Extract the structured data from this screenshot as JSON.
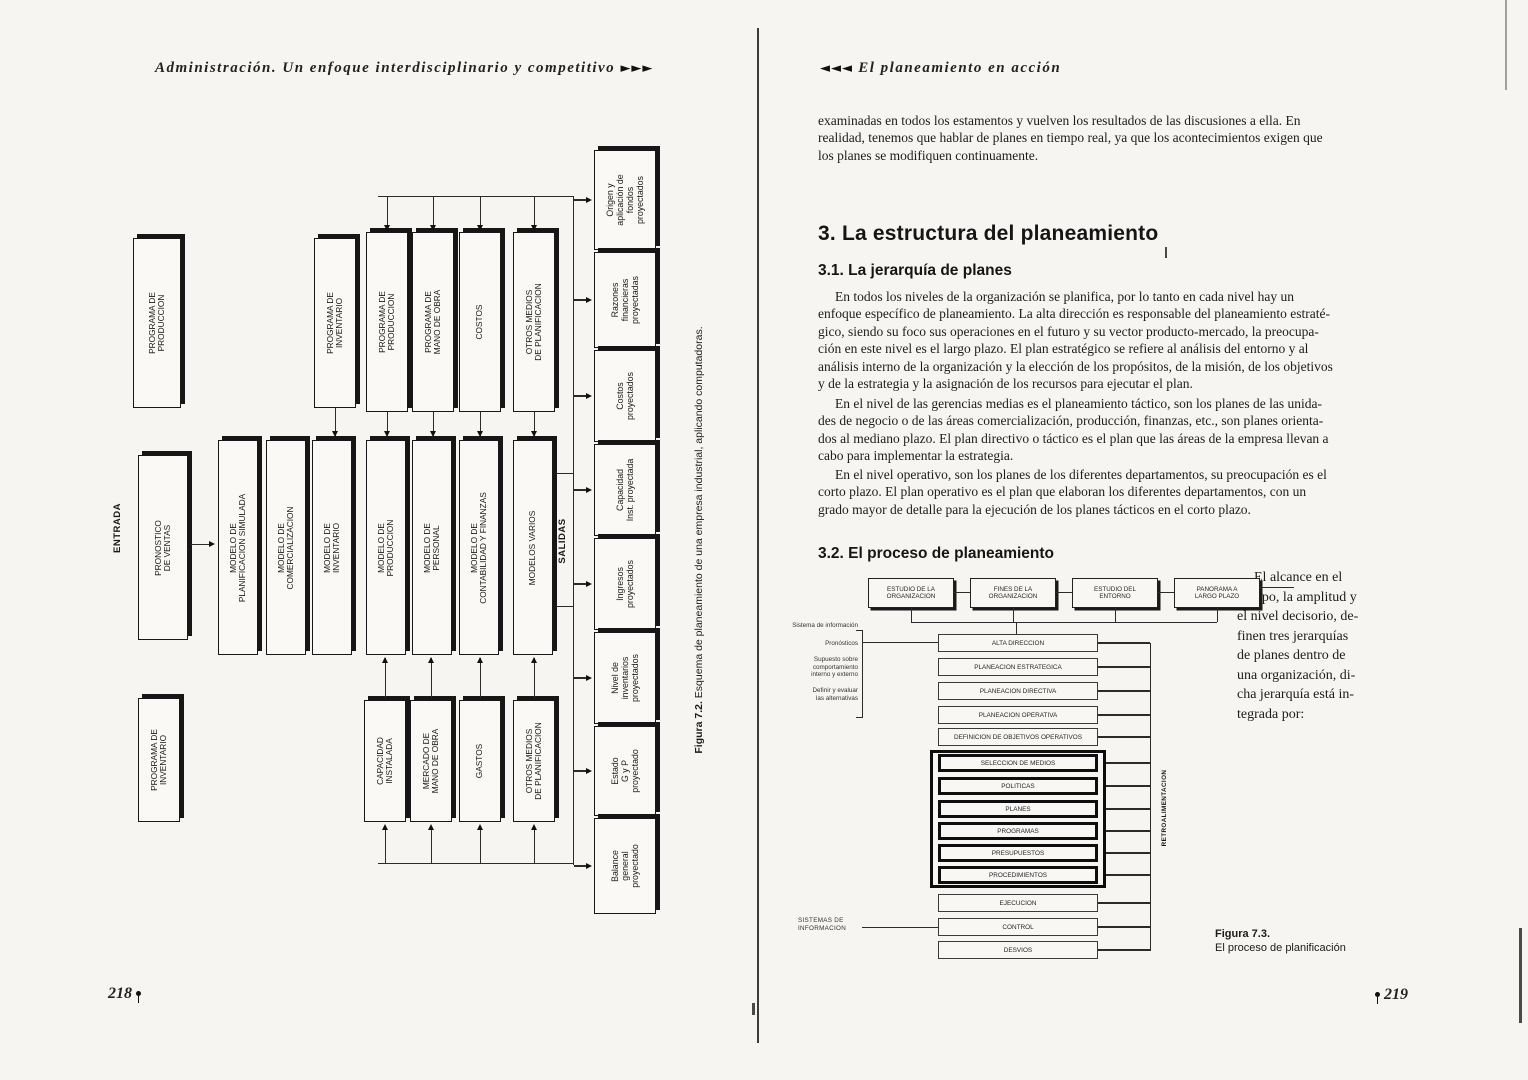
{
  "left_page": {
    "running_header": "Administración. Un enfoque interdisciplinario y competitivo",
    "running_header_arrows": "►►►",
    "page_number": "218",
    "figure": {
      "caption_label": "Figura 7.2.",
      "caption_text": "Esquema de planeamiento de una empresa industrial, aplicando computadoras.",
      "entrada_label": "ENTRADA",
      "salidas_label": "SALIDAS",
      "input_box": "PRONOSTICO\nDE VENTAS",
      "standalone_top": "PROGRAMA DE\nPRODUCCION",
      "standalone_bottom": "PROGRAMA DE\nINVENTARIO",
      "programs_top": [
        "PROGRAMA DE\nINVENTARIO",
        "PROGRAMA DE\nPRODUCCION",
        "PROGRAMA DE\nMANO DE OBRA",
        "COSTOS",
        "OTROS MEDIOS\nDE PLANIFICACION"
      ],
      "models": [
        "MODELO DE\nPLANIFICACION SIMULADA",
        "MODELO DE\nCOMERCIALIZACION",
        "MODELO DE\nINVENTARIO",
        "MODELO DE\nPRODUCCION",
        "MODELO DE\nPERSONAL",
        "MODELO DE\nCONTABILIDAD Y FINANZAS",
        "MODELOS VARIOS"
      ],
      "resources_bottom": [
        "CAPACIDAD\nINSTALADA",
        "MERCADO DE\nMANO DE OBRA",
        "GASTOS",
        "OTROS MEDIOS\nDE PLANIFICACION"
      ],
      "outputs": [
        "Origen y\naplicación de\nfondos\nproyectados",
        "Razones\nfinancieras\nproyectadas",
        "Costos\nproyectados",
        "Capacidad\nInst. proyectada",
        "Ingresos\nproyectados",
        "Nivel de\ninventarios\nproyectados",
        "Estado\nG y P\nproyectado",
        "Balance\ngeneral\nproyectado"
      ]
    }
  },
  "right_page": {
    "running_header": "El planeamiento en acción",
    "running_header_arrows": "◄◄◄",
    "page_number": "219",
    "intro_paragraph": "examinadas en todos los estamentos y vuelven los resultados de las discusiones a ella. En\nrealidad, tenemos que hablar de planes en tiempo real, ya que los acontecimientos exigen que\nlos planes se modifiquen continuamente.",
    "section3_title": "3. La estructura del planeamiento",
    "section31": {
      "title": "3.1. La jerarquía de planes",
      "p1": "En todos los niveles de la organización se planifica, por lo tanto en cada nivel hay un\nenfoque específico de planeamiento. La alta dirección es responsable del planeamiento estraté-\ngico, siendo su foco sus operaciones en el futuro y su vector producto-mercado, la preocupa-\nción en este nivel es el largo plazo. El plan estratégico se refiere al análisis del entorno y al\nanálisis interno de la organización y la elección de los propósitos, de la misión, de los objetivos\ny de la estrategia y la asignación de los recursos para ejecutar el plan.",
      "p2": "En el nivel de las gerencias medias es el planeamiento táctico, son los planes de las unida-\ndes de negocio o de las áreas comercialización, producción, finanzas, etc., son planes orienta-\ndos al mediano plazo. El plan directivo o táctico es el plan que las áreas de la empresa llevan a\ncabo para implementar la estrategia.",
      "p3": "En el nivel operativo, son los planes de los diferentes departamentos, su preocupación es el\ncorto plazo. El plan operativo es el plan que elaboran los diferentes departamentos, con un\ngrado mayor de detalle para la ejecución de los planes tácticos en el corto plazo."
    },
    "section32": {
      "title": "3.2. El proceso de planeamiento",
      "side_text": "El alcance en el\ntiempo, la amplitud y\nel nivel decisorio, de-\nfinen tres jerarquías\nde planes dentro de\nuna organización, di-\ncha jerarquía está in-\ntegrada por:"
    },
    "figure": {
      "caption_label": "Figura 7.3.",
      "caption_text": "El proceso de planificación",
      "top_row": [
        "ESTUDIO DE LA\nORGANIZACION",
        "FINES DE LA\nORGANIZACION",
        "ESTUDIO DEL\nENTORNO",
        "PANORAMA A\nLARGO PLAZO"
      ],
      "stack": [
        "ALTA DIRECCION",
        "PLANEACION ESTRATEGICA",
        "PLANEACION DIRECTIVA",
        "PLANEACION OPERATIVA",
        "DEFINICION DE OBJETIVOS OPERATIVOS"
      ],
      "bold_stack": [
        "SELECCION DE MEDIOS",
        "POLITICAS",
        "PLANES",
        "PROGRAMAS",
        "PRESUPUESTOS",
        "PROCEDIMIENTOS"
      ],
      "bottom_stack": [
        "EJECUCION",
        "CONTROL",
        "DESVIOS"
      ],
      "feedback_label": "RETROALIMENTACION",
      "left_notes": [
        "Sistema de información",
        "Pronósticos",
        "Supuesto sobre\ncomportamiento\ninterno y externo",
        "Definir y evaluar\nlas alternativas"
      ],
      "sistemas_label": "SISTEMAS DE\nINFORMACION"
    }
  }
}
